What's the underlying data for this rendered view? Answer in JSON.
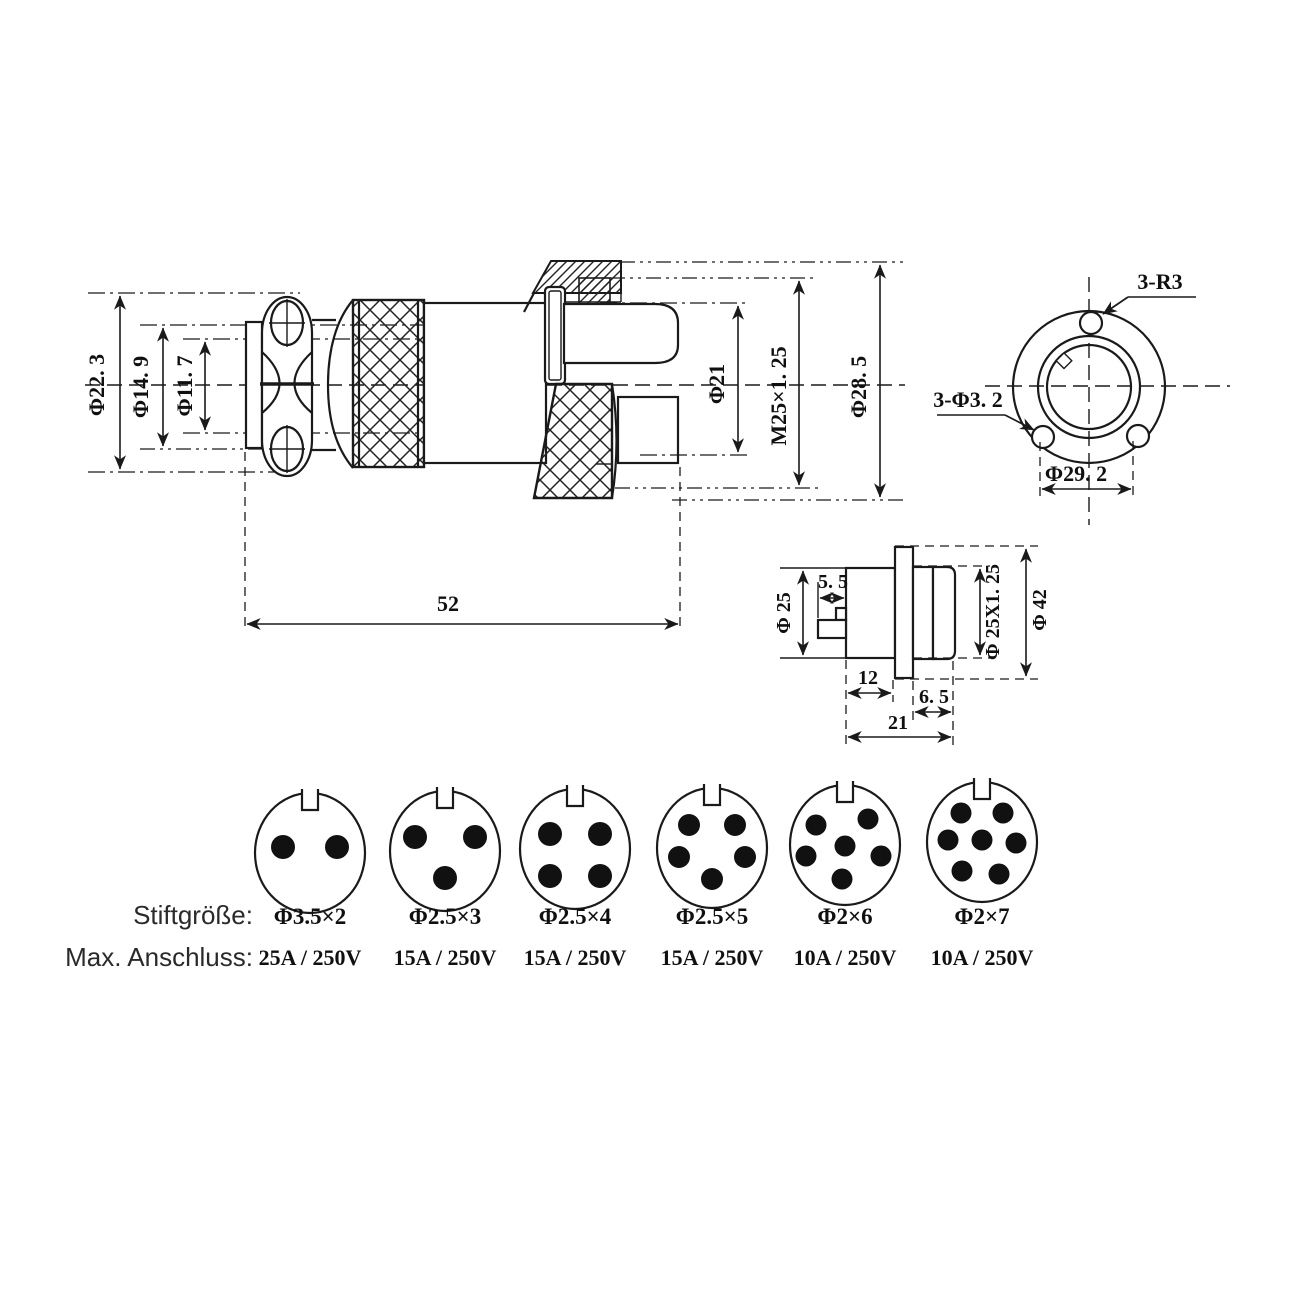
{
  "page": {
    "background": "#ffffff",
    "line_color": "#1a1a1a"
  },
  "main_view": {
    "title": "plug-assembly-side-view",
    "dims": {
      "outer": "Φ22. 3",
      "mid": "Φ14. 9",
      "inner": "Φ11. 7",
      "shell": "Φ21",
      "thread": "M25×1. 25",
      "nut": "Φ28. 5",
      "length": "52"
    }
  },
  "face_view": {
    "title": "flange-front-view",
    "labels": {
      "fillet": "3-R3",
      "holes": "3-Φ3. 2",
      "bolt_circle": "Φ29. 2"
    }
  },
  "socket_view": {
    "title": "panel-socket-side-view",
    "dims": {
      "body": "Φ 25",
      "pin_width": "5. 5",
      "thread": "Φ 25X1. 25",
      "flange": "Φ 42",
      "body_len": "12",
      "front_len": "6. 5",
      "total_len": "21"
    }
  },
  "pin_table": {
    "size_row_label": "Stiftgröße:",
    "rating_row_label": "Max. Anschluss:",
    "variants": [
      {
        "pins": 2,
        "pin_size": "Φ3.5×2",
        "max_rating": "25A / 250V"
      },
      {
        "pins": 3,
        "pin_size": "Φ2.5×3",
        "max_rating": "15A / 250V"
      },
      {
        "pins": 4,
        "pin_size": "Φ2.5×4",
        "max_rating": "15A / 250V"
      },
      {
        "pins": 5,
        "pin_size": "Φ2.5×5",
        "max_rating": "15A / 250V"
      },
      {
        "pins": 6,
        "pin_size": "Φ2×6",
        "max_rating": "10A / 250V"
      },
      {
        "pins": 7,
        "pin_size": "Φ2×7",
        "max_rating": "10A / 250V"
      }
    ]
  }
}
